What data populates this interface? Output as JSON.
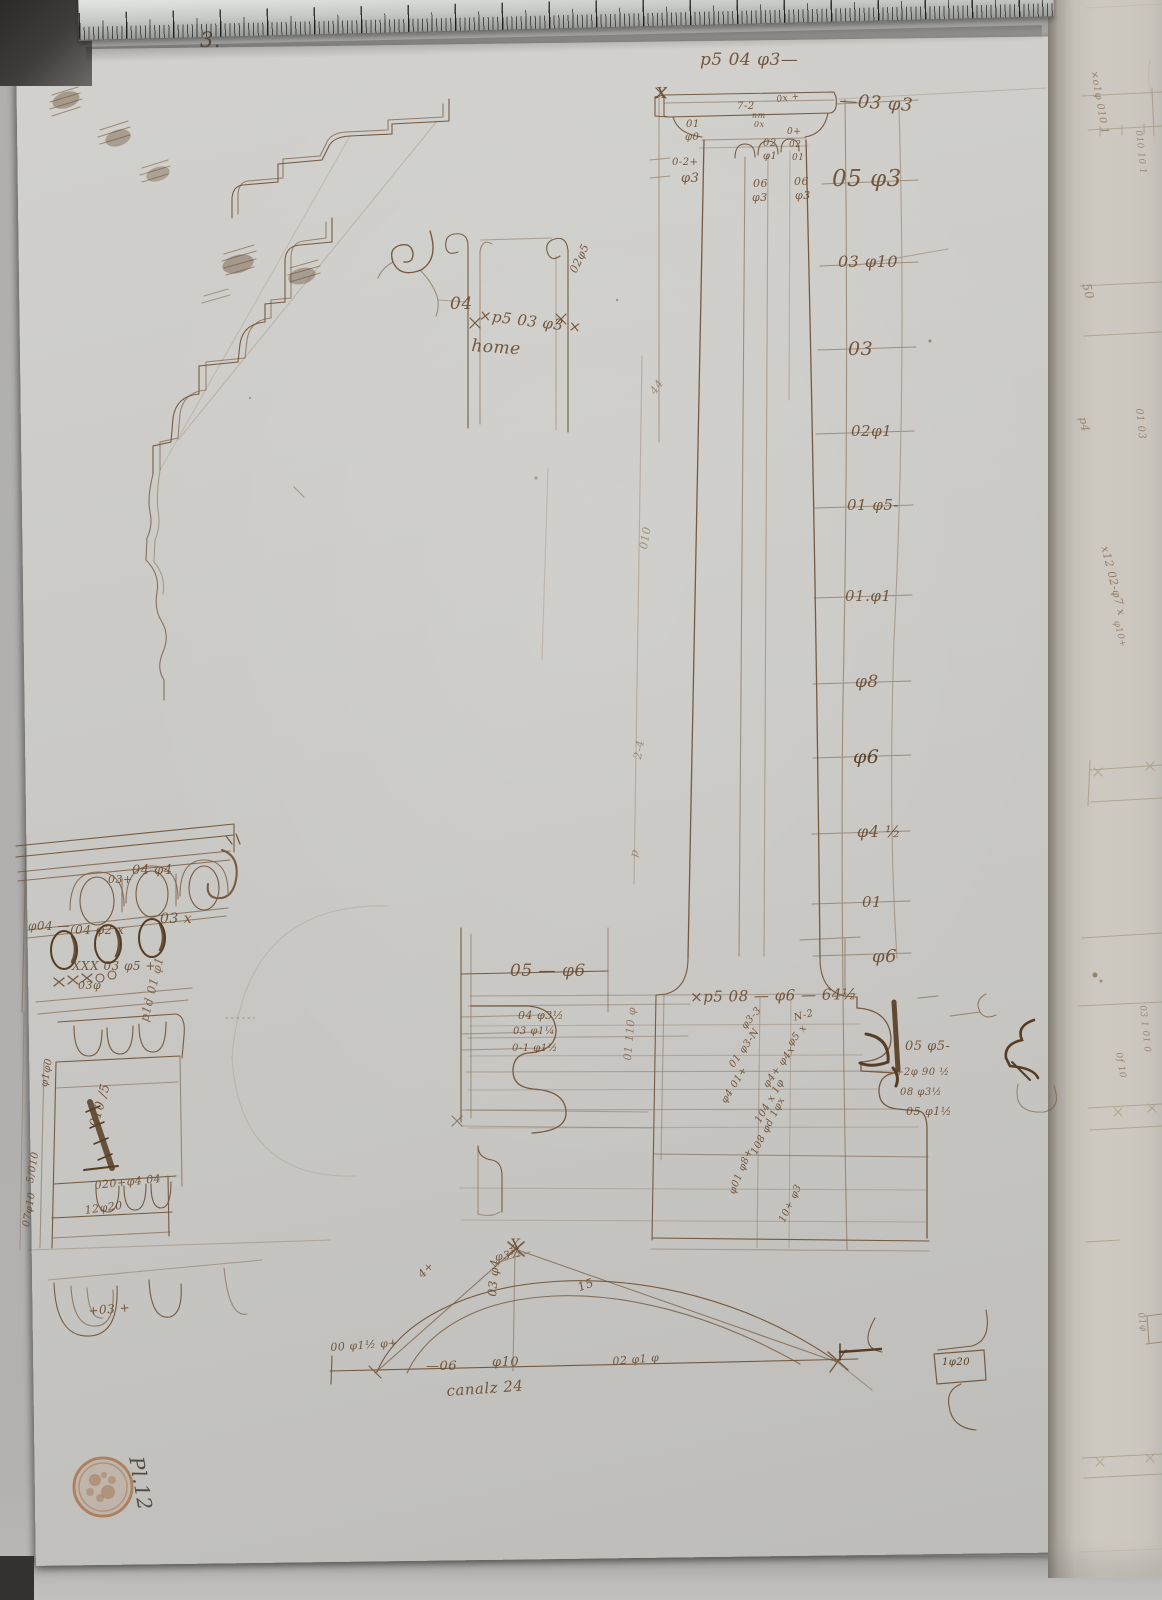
{
  "document": {
    "kind": "manuscript architectural drawing, pen and brown ink on paper",
    "page_number": "3.",
    "inventory_mark": "Pl.12",
    "stamp": "round-collection-stamp",
    "flute_note": "canalz 24"
  },
  "colors": {
    "ink": "#6b4a2e",
    "ink_dark": "#4c3014",
    "ink_faint": "#93795a",
    "paper": "#cbcac6",
    "facing_page": "#ccc8c0",
    "table": "#b2b1af",
    "ruler_metal": "#dcded9",
    "stamp": "#a5683f"
  },
  "annotations": [
    {
      "t": "3.",
      "x": 200,
      "y": 30,
      "s": 21,
      "c": "#4a4238"
    },
    {
      "t": "p5 04 φ3—",
      "x": 700,
      "y": 52,
      "s": 17
    },
    {
      "t": "X",
      "x": 656,
      "y": 86,
      "s": 15
    },
    {
      "t": "—03 φ3",
      "x": 840,
      "y": 92,
      "s": 18,
      "r": 4
    },
    {
      "t": "05 φ3",
      "x": 832,
      "y": 168,
      "s": 23
    },
    {
      "t": "01",
      "x": 686,
      "y": 120,
      "s": 10
    },
    {
      "t": "φ0",
      "x": 685,
      "y": 133,
      "s": 10
    },
    {
      "t": "0-2+",
      "x": 672,
      "y": 158,
      "s": 10
    },
    {
      "t": "φ3",
      "x": 681,
      "y": 172,
      "s": 13
    },
    {
      "t": "7-2",
      "x": 737,
      "y": 102,
      "s": 10
    },
    {
      "t": "0x +",
      "x": 776,
      "y": 96,
      "s": 9,
      "r": -8
    },
    {
      "t": "nm",
      "x": 752,
      "y": 112,
      "s": 8
    },
    {
      "t": "0x",
      "x": 754,
      "y": 121,
      "s": 8
    },
    {
      "t": "02",
      "x": 763,
      "y": 139,
      "s": 10
    },
    {
      "t": "φ1",
      "x": 763,
      "y": 152,
      "s": 10
    },
    {
      "t": "0+",
      "x": 787,
      "y": 128,
      "s": 9
    },
    {
      "t": "02",
      "x": 789,
      "y": 141,
      "s": 9
    },
    {
      "t": "01",
      "x": 792,
      "y": 154,
      "s": 9
    },
    {
      "t": "06",
      "x": 753,
      "y": 178,
      "s": 11
    },
    {
      "t": "φ3",
      "x": 752,
      "y": 192,
      "s": 11
    },
    {
      "t": "06",
      "x": 794,
      "y": 176,
      "s": 11
    },
    {
      "t": "φ3",
      "x": 795,
      "y": 190,
      "s": 11
    },
    {
      "t": "03 φ10",
      "x": 838,
      "y": 254,
      "s": 16
    },
    {
      "t": "03",
      "x": 848,
      "y": 340,
      "s": 19
    },
    {
      "t": "02φ1",
      "x": 851,
      "y": 424,
      "s": 15
    },
    {
      "t": "01 φ5-",
      "x": 847,
      "y": 498,
      "s": 15
    },
    {
      "t": "01.φ1",
      "x": 845,
      "y": 589,
      "s": 15
    },
    {
      "t": "φ8",
      "x": 855,
      "y": 674,
      "s": 17
    },
    {
      "t": "φ6",
      "x": 853,
      "y": 748,
      "s": 19,
      "c": "#54351c"
    },
    {
      "t": "φ4 ½",
      "x": 857,
      "y": 824,
      "s": 16
    },
    {
      "t": "01",
      "x": 862,
      "y": 895,
      "s": 15
    },
    {
      "t": "φ6",
      "x": 872,
      "y": 948,
      "s": 18
    },
    {
      "t": "×p5 08 — φ6 — 64½",
      "x": 690,
      "y": 990,
      "s": 15,
      "r": -1
    },
    {
      "t": "05 φ5-",
      "x": 905,
      "y": 1040,
      "s": 13
    },
    {
      "t": "+2φ 90 ½",
      "x": 895,
      "y": 1068,
      "s": 10
    },
    {
      "t": "08 φ3½",
      "x": 900,
      "y": 1088,
      "s": 10
    },
    {
      "t": "05 φ1½",
      "x": 906,
      "y": 1106,
      "s": 11
    },
    {
      "t": "N-2",
      "x": 793,
      "y": 1014,
      "s": 10,
      "r": -15
    },
    {
      "t": "φ3-3",
      "x": 740,
      "y": 1025,
      "s": 10,
      "r": -50
    },
    {
      "t": "φ5 x",
      "x": 786,
      "y": 1042,
      "s": 10,
      "r": -50
    },
    {
      "t": "01 φ3-N",
      "x": 728,
      "y": 1064,
      "s": 10,
      "r": -55
    },
    {
      "t": "φ4+ φ4x",
      "x": 762,
      "y": 1084,
      "s": 10,
      "r": -55
    },
    {
      "t": "φ4 01+",
      "x": 720,
      "y": 1100,
      "s": 10,
      "r": -58
    },
    {
      "t": "104 x 1φ",
      "x": 754,
      "y": 1120,
      "s": 10,
      "r": -60
    },
    {
      "t": "108 φd 1φx",
      "x": 750,
      "y": 1152,
      "s": 10,
      "r": -63
    },
    {
      "t": "φ01 φ8+",
      "x": 728,
      "y": 1192,
      "s": 10,
      "r": -68
    },
    {
      "t": "10+ φ3",
      "x": 778,
      "y": 1220,
      "s": 10,
      "r": -65
    },
    {
      "t": "05 — φ6",
      "x": 510,
      "y": 963,
      "s": 17
    },
    {
      "t": "04 φ3½",
      "x": 518,
      "y": 1010,
      "s": 11
    },
    {
      "t": "03 φ1¼",
      "x": 513,
      "y": 1027,
      "s": 10
    },
    {
      "t": "0-1 φ1½",
      "x": 512,
      "y": 1044,
      "s": 10
    },
    {
      "t": "01 110 φ",
      "x": 622,
      "y": 1060,
      "s": 11,
      "r": -85,
      "o": 0.6
    },
    {
      "t": "44",
      "x": 648,
      "y": 390,
      "s": 11,
      "r": -55,
      "o": 0.5
    },
    {
      "t": "010",
      "x": 638,
      "y": 548,
      "s": 11,
      "r": -80,
      "o": 0.5
    },
    {
      "t": "2-4",
      "x": 632,
      "y": 758,
      "s": 11,
      "r": -80,
      "o": 0.5
    },
    {
      "t": "p",
      "x": 628,
      "y": 856,
      "s": 11,
      "r": -80,
      "o": 0.5
    },
    {
      "t": "04",
      "x": 450,
      "y": 296,
      "s": 17
    },
    {
      "t": "×p5 03 φ3 ×",
      "x": 480,
      "y": 308,
      "s": 15,
      "r": 7
    },
    {
      "t": "02φ5",
      "x": 568,
      "y": 270,
      "s": 11,
      "r": -65
    },
    {
      "t": "home",
      "x": 472,
      "y": 338,
      "s": 17,
      "r": 4
    },
    {
      "t": "03+",
      "x": 108,
      "y": 874,
      "s": 11
    },
    {
      "t": "04 φ4",
      "x": 132,
      "y": 864,
      "s": 13
    },
    {
      "t": "φ04 —",
      "x": 28,
      "y": 920,
      "s": 12
    },
    {
      "t": "(04 φ2 x",
      "x": 70,
      "y": 924,
      "s": 12
    },
    {
      "t": "03 x",
      "x": 160,
      "y": 912,
      "s": 14
    },
    {
      "t": "XXX 03 φ5 +",
      "x": 72,
      "y": 960,
      "s": 12
    },
    {
      "t": "03φ",
      "x": 78,
      "y": 980,
      "s": 11
    },
    {
      "t": "p1d 01 φ1",
      "x": 138,
      "y": 1020,
      "s": 12,
      "r": -76,
      "o": 0.75
    },
    {
      "t": "φ1φ0",
      "x": 40,
      "y": 1086,
      "s": 10,
      "r": -80
    },
    {
      "t": "010 /5",
      "x": 88,
      "y": 1125,
      "s": 13,
      "r": -74
    },
    {
      "t": "020+φ4 04",
      "x": 94,
      "y": 1180,
      "s": 11,
      "r": -6
    },
    {
      "t": "12φ20",
      "x": 84,
      "y": 1205,
      "s": 11,
      "r": -8
    },
    {
      "t": "5/010",
      "x": 26,
      "y": 1182,
      "s": 10,
      "r": -80
    },
    {
      "t": "07φ10",
      "x": 22,
      "y": 1226,
      "s": 10,
      "r": -80
    },
    {
      "t": "+03 +",
      "x": 88,
      "y": 1305,
      "s": 12,
      "r": -5
    },
    {
      "t": "X",
      "x": 510,
      "y": 1238,
      "s": 14
    },
    {
      "t": "φ3½",
      "x": 494,
      "y": 1252,
      "s": 11,
      "r": -10
    },
    {
      "t": "4+",
      "x": 416,
      "y": 1272,
      "s": 11,
      "r": -45
    },
    {
      "t": "15",
      "x": 576,
      "y": 1282,
      "s": 12,
      "r": -20
    },
    {
      "t": "03 φ4",
      "x": 486,
      "y": 1296,
      "s": 12,
      "r": -85
    },
    {
      "t": "00 φ1½ φ+",
      "x": 330,
      "y": 1342,
      "s": 11,
      "r": -4
    },
    {
      "t": "—06",
      "x": 426,
      "y": 1360,
      "s": 13
    },
    {
      "t": "φ10",
      "x": 492,
      "y": 1356,
      "s": 13
    },
    {
      "t": "02 φ1 φ",
      "x": 612,
      "y": 1356,
      "s": 11,
      "r": -5
    },
    {
      "t": "canalz 24",
      "x": 446,
      "y": 1384,
      "s": 15,
      "r": -4
    },
    {
      "t": "1φ20",
      "x": 942,
      "y": 1358,
      "s": 10,
      "c": "#4e2f16"
    },
    {
      "t": "Pl.12",
      "x": 146,
      "y": 1455,
      "s": 20,
      "r": 80,
      "c": "#45413a"
    },
    {
      "t": "×o1φ 010 1",
      "x": 1098,
      "y": 70,
      "s": 10,
      "r": 80,
      "o": 0.55
    },
    {
      "t": "010 10 1",
      "x": 1142,
      "y": 130,
      "s": 9,
      "r": 84,
      "o": 0.5
    },
    {
      "t": "50",
      "x": 1092,
      "y": 282,
      "s": 12,
      "r": 76,
      "o": 0.5
    },
    {
      "t": "p4",
      "x": 1088,
      "y": 416,
      "s": 11,
      "r": 78,
      "o": 0.5
    },
    {
      "t": "01 03",
      "x": 1143,
      "y": 408,
      "s": 10,
      "r": 84,
      "o": 0.5
    },
    {
      "t": "x12 02-φ7 x",
      "x": 1110,
      "y": 545,
      "s": 11,
      "r": 76,
      "o": 0.6
    },
    {
      "t": "φ10+",
      "x": 1120,
      "y": 620,
      "s": 9,
      "r": 76,
      "o": 0.55
    },
    {
      "t": "03 1 01 0",
      "x": 1146,
      "y": 1005,
      "s": 9,
      "r": 84,
      "o": 0.5
    },
    {
      "t": "0f 10",
      "x": 1122,
      "y": 1052,
      "s": 9,
      "r": 80,
      "o": 0.55
    },
    {
      "t": "01φ",
      "x": 1144,
      "y": 1312,
      "s": 9,
      "r": 80,
      "o": 0.5
    }
  ]
}
